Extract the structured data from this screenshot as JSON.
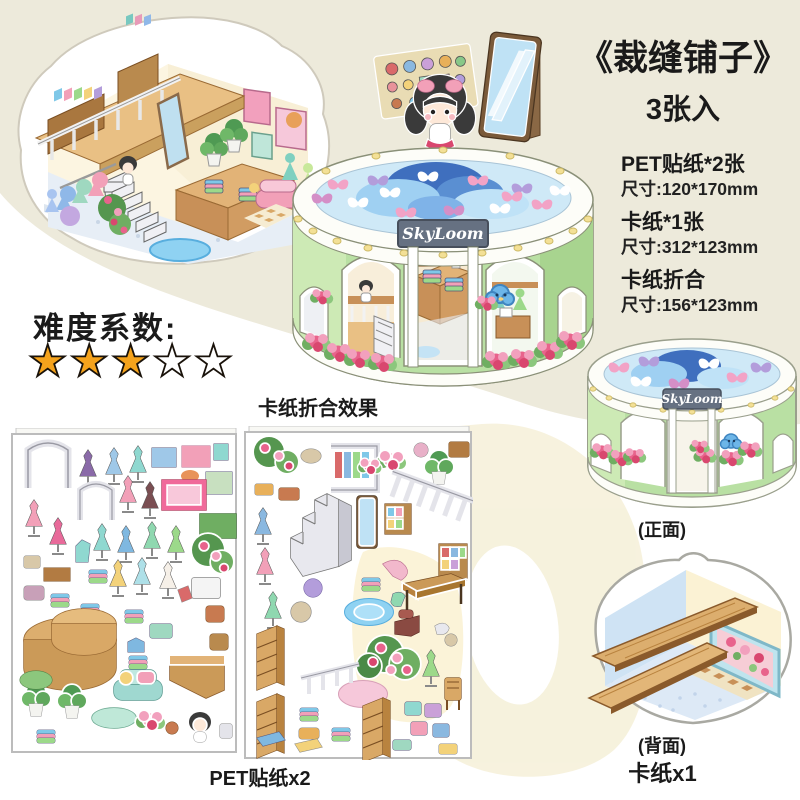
{
  "header": {
    "title": "《裁缝铺子》",
    "subtitle": "3张入"
  },
  "specs": [
    {
      "name": "PET贴纸*2张",
      "size": "尺寸:120*170mm"
    },
    {
      "name": "卡纸*1张",
      "size": "尺寸:312*123mm"
    },
    {
      "name": "卡纸折合",
      "size": "尺寸:156*123mm"
    }
  ],
  "difficulty": {
    "label": "难度系数:",
    "filled": 3,
    "total": 5,
    "stars_filled": "★★★",
    "stars_empty": "★★"
  },
  "shop": {
    "sign": "SkyLoom",
    "folded_caption": "卡纸折合效果"
  },
  "sheets": {
    "pet_label": "PET贴纸x2"
  },
  "cards": {
    "front_label": "(正面)",
    "back_label": "(背面)",
    "count_label": "卡纸x1"
  },
  "colors": {
    "background_top": "#edeadb",
    "background_bottom": "#ffffff",
    "watermark_cream": "#f6f1da",
    "shop_green": "#b9e0a3",
    "sign_slate": "#667182",
    "star_orange": "#f5a31c",
    "cloud_blue_dark": "#3f6fbe",
    "cloud_blue_light": "#a7d3f0",
    "flower_pink": "#e8638c",
    "wood_tan": "#dcae6e"
  },
  "icons": {
    "star_icon": "★",
    "butterfly_icon": "butterfly",
    "flower_icon": "flower-cluster",
    "mirror_icon": "standing-mirror",
    "girl_icon": "girl-character",
    "cloud_icon": "cloud-mascot"
  }
}
